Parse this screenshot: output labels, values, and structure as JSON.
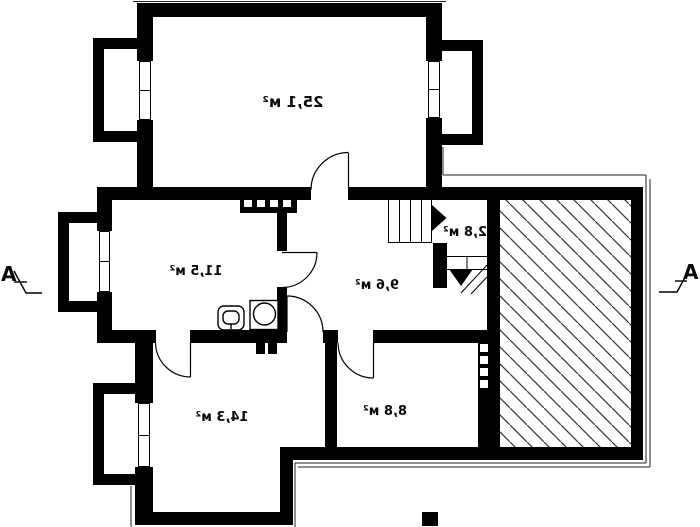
{
  "plan": {
    "type": "floor-plan",
    "mirrored_text": true,
    "rooms": [
      {
        "name": "living-room",
        "area_label": "25,1 м²"
      },
      {
        "name": "kitchen",
        "area_label": "11,5 м²"
      },
      {
        "name": "hall",
        "area_label": "9,6 м²"
      },
      {
        "name": "stairs",
        "area_label": "2,8 м²"
      },
      {
        "name": "bedroom",
        "area_label": "14,3 м²"
      },
      {
        "name": "small-room",
        "area_label": "8,8 м²"
      }
    ],
    "section_markers": {
      "left_label": "A",
      "right_label": "A"
    },
    "areas": {
      "hatched_area": "garage (diagonal hatch, unlabeled)"
    },
    "colors": {
      "wall": "#000000",
      "background": "#ffffff",
      "hatch_line": "#3a3a3a",
      "thin_line": "#222222"
    }
  }
}
